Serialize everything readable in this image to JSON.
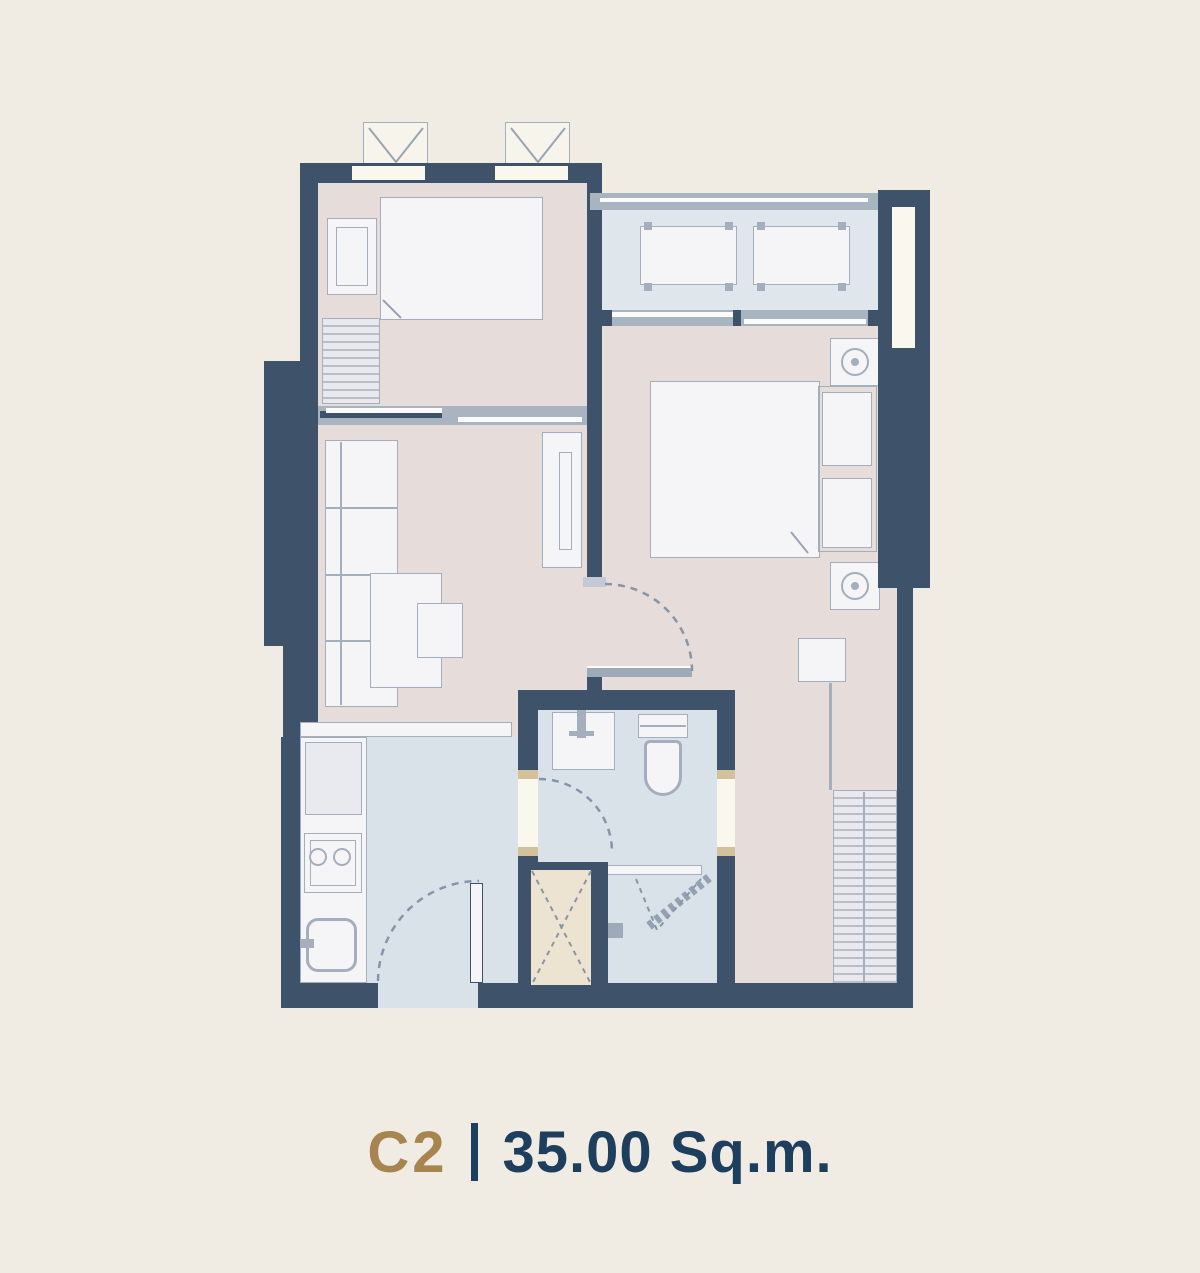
{
  "unit_label": {
    "code": "C2",
    "separator": "|",
    "area": "35.00 Sq.m."
  },
  "palette": {
    "background": "#f0ece3",
    "wall": "#3e5269",
    "floor_warm": "#e6dcd9",
    "floor_cool": "#d9e2e9",
    "floor_balcony": "#dfe7ed",
    "furniture_fill": "#f5f5f7",
    "furniture_outline": "#a5aebd",
    "track": "#a9b4c1",
    "panel": "#fbfbfc",
    "shaft_fill": "#ece3d0",
    "jamb": "#d3c19c",
    "dash": "#8795a8",
    "accent_gold": "#a8854f",
    "text_navy": "#1d3e5c"
  },
  "fixtures": [
    "bedroom-2-bed",
    "bedroom-2-side-table",
    "bedroom-2-dresser",
    "ac-condenser-unit",
    "balcony-ac-unit",
    "master-bed",
    "pillows",
    "nightstand",
    "bedside-lamp",
    "stool",
    "wardrobe",
    "sofa",
    "coffee-table",
    "tv-cabinet",
    "kitchen-counter",
    "fridge",
    "stove",
    "sink",
    "wash-basin",
    "toilet",
    "shower",
    "service-shaft",
    "entrance-door",
    "door-swing-arc",
    "sliding-door",
    "window"
  ]
}
